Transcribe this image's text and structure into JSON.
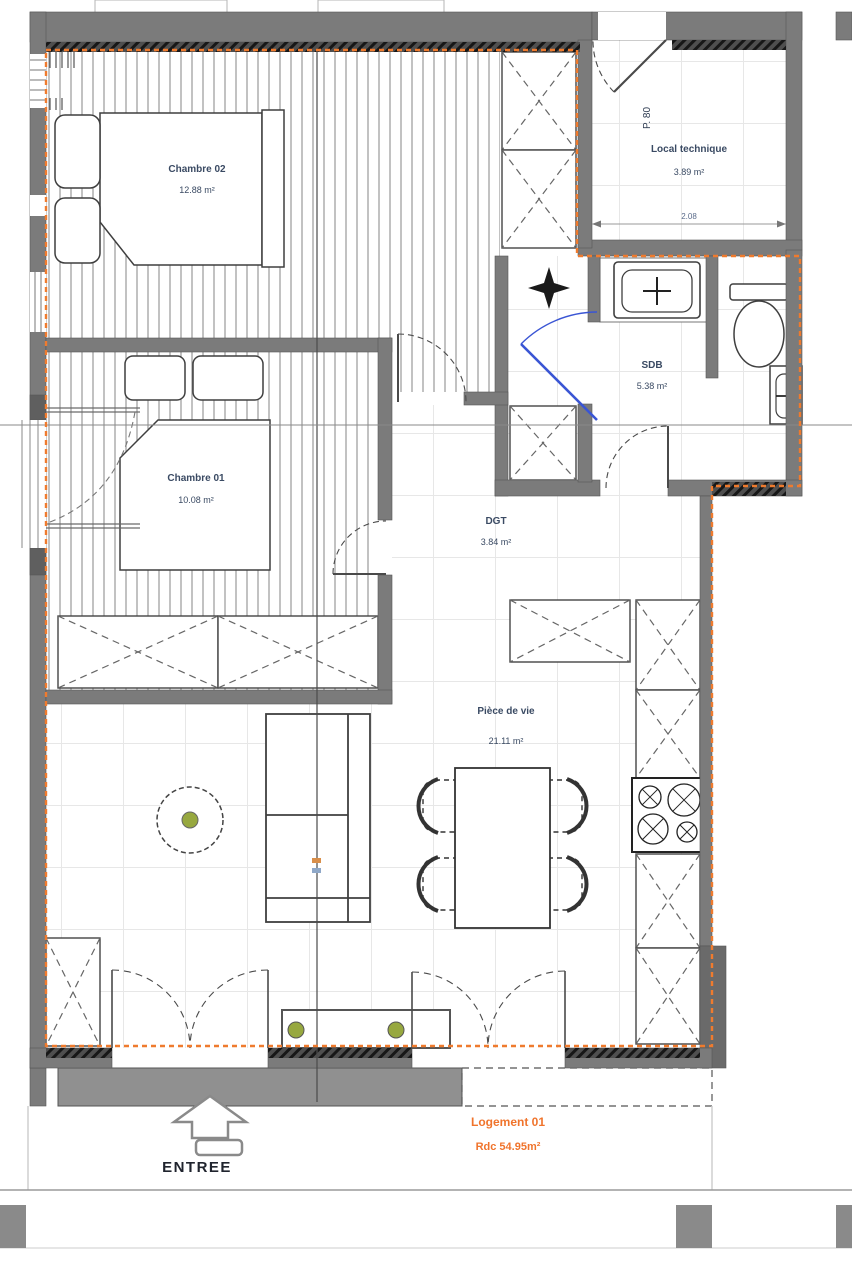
{
  "plan": {
    "rooms": [
      {
        "name": "Chambre 02",
        "area": "12.88 m²"
      },
      {
        "name": "Chambre 01",
        "area": "10.08 m²"
      },
      {
        "name": "Local technique",
        "area": "3.89 m²"
      },
      {
        "name": "SDB",
        "area": "5.38 m²"
      },
      {
        "name": "DGT",
        "area": "3.84 m²"
      },
      {
        "name": "Pièce de vie",
        "area": "21.11 m²"
      }
    ],
    "entrance_label": "ENTREE",
    "unit": {
      "name": "Logement 01",
      "area": "Rdc 54.95m²"
    },
    "door_label": "P. 80",
    "dims": {
      "local_technique_width": "2.08"
    },
    "colors": {
      "boundary_orange": "#ef7b2e",
      "door_blue": "#3a55d4",
      "wall_gray": "#7b7b7b",
      "label_blue": "#3a4a63",
      "accent_green": "#97a83f"
    }
  }
}
